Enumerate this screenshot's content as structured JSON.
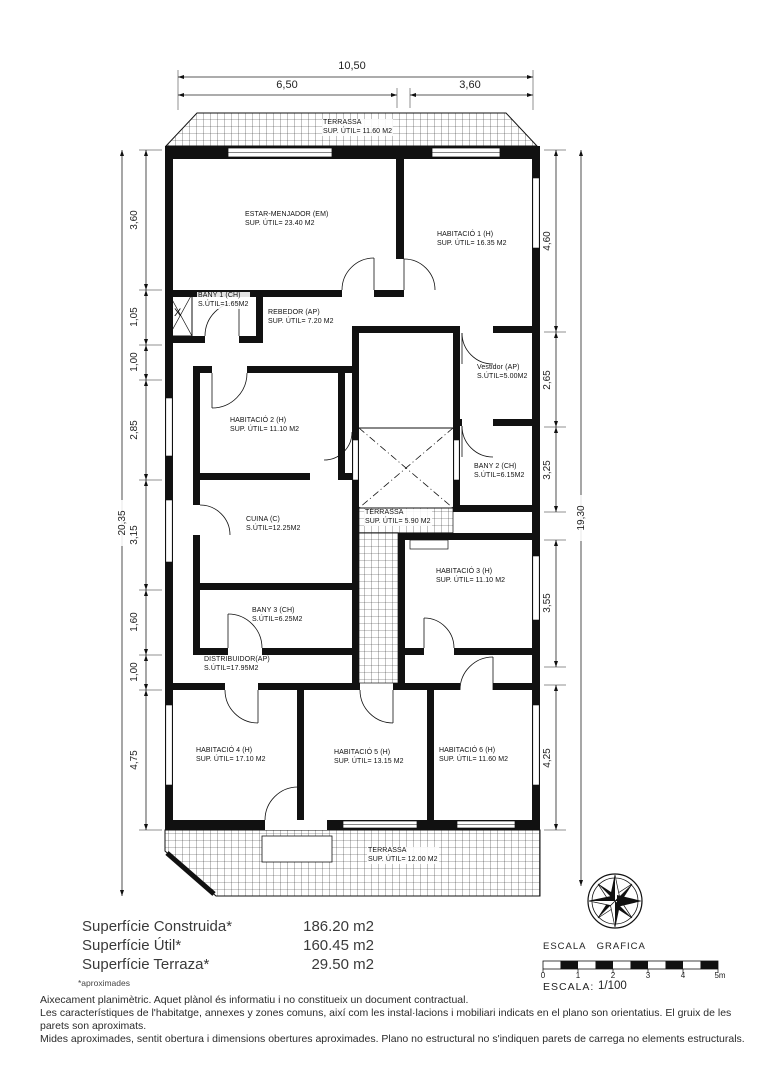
{
  "plan": {
    "rooms": {
      "terrassa_top": {
        "name": "TERRASSA",
        "area": "SUP. ÚTIL= 11.60 M2"
      },
      "estar": {
        "name": "ESTAR-MENJADOR (EM)",
        "area": "SUP. ÚTIL= 23.40 M2"
      },
      "hab1": {
        "name": "HABITACIÓ 1 (H)",
        "area": "SUP. ÚTIL= 16.35 M2"
      },
      "bany1": {
        "name": "BANY 1 (CH)",
        "area": "S.ÚTIL=1.65M2"
      },
      "rebedor": {
        "name": "REBEDOR (AP)",
        "area": "SUP. ÚTIL= 7.20 M2"
      },
      "vestidor": {
        "name": "Vestidor (AP)",
        "area": "S.ÚTIL=5.00M2"
      },
      "hab2": {
        "name": "HABITACIÓ 2 (H)",
        "area": "SUP. ÚTIL= 11.10 M2"
      },
      "bany2": {
        "name": "BANY 2 (CH)",
        "area": "S.ÚTIL=6.15M2"
      },
      "cuina": {
        "name": "CUINA (C)",
        "area": "S.ÚTIL=12.25M2"
      },
      "terrassa_mid": {
        "name": "TERRASSA",
        "area": "SUP. ÚTIL= 5.90 M2"
      },
      "hab3": {
        "name": "HABITACIÓ 3 (H)",
        "area": "SUP. ÚTIL= 11.10 M2"
      },
      "bany3": {
        "name": "BANY 3 (CH)",
        "area": "S.ÚTIL=6.25M2"
      },
      "distribuidor": {
        "name": "DISTRIBUIDOR(AP)",
        "area": "S.ÚTIL=17.95M2"
      },
      "hab4": {
        "name": "HABITACIÓ 4 (H)",
        "area": "SUP. ÚTIL= 17.10 M2"
      },
      "hab5": {
        "name": "HABITACIÓ 5 (H)",
        "area": "SUP. ÚTIL= 13.15 M2"
      },
      "hab6": {
        "name": "HABITACIÓ 6 (H)",
        "area": "SUP. ÚTIL= 11.60 M2"
      },
      "terrassa_bot": {
        "name": "TERRASSA",
        "area": "SUP. ÚTIL= 12.00 M2"
      }
    },
    "shaft_label": "X"
  },
  "dimensions": {
    "top": {
      "overall": "10,50",
      "left": "6,50",
      "right": "3,60"
    },
    "left": {
      "overall": "20,35",
      "segments": [
        "3,60",
        "1,05",
        "1,00",
        "2,85",
        "3,15",
        "1,60",
        "1,00",
        "4,75"
      ]
    },
    "right": {
      "overall": "19,30",
      "segments": [
        "4,60",
        "2,65",
        "3,25",
        "3,55",
        "4,25"
      ]
    }
  },
  "summary": {
    "rows": [
      {
        "label": "Superfície Construida*",
        "value": "186.20 m2"
      },
      {
        "label": "Superfície Útil*",
        "value": "160.45 m2"
      },
      {
        "label": "Superfície Terraza*",
        "value": "29.50 m2"
      }
    ],
    "note": "*aproximades"
  },
  "scale": {
    "heading": "ESCALA GRAFICA",
    "ticks": [
      "0",
      "1",
      "2",
      "3",
      "4",
      "5m"
    ],
    "label": "ESCALA:",
    "value": "1/100"
  },
  "footer": {
    "lines": [
      "Aixecament planimètric. Aquet plànol és informatiu i no constitueix un document contractual.",
      "Les característiques de l'habitatge, annexes y zones comuns, així com les instal·lacions i mobiliari indicats en el plano son orientatius. El gruix de les parets son aproximats.",
      "Mides aproximades, sentit obertura i dimensions obertures aproximades.  Plano no estructural no s'indiquen parets de carrega no elements estructurals."
    ]
  }
}
